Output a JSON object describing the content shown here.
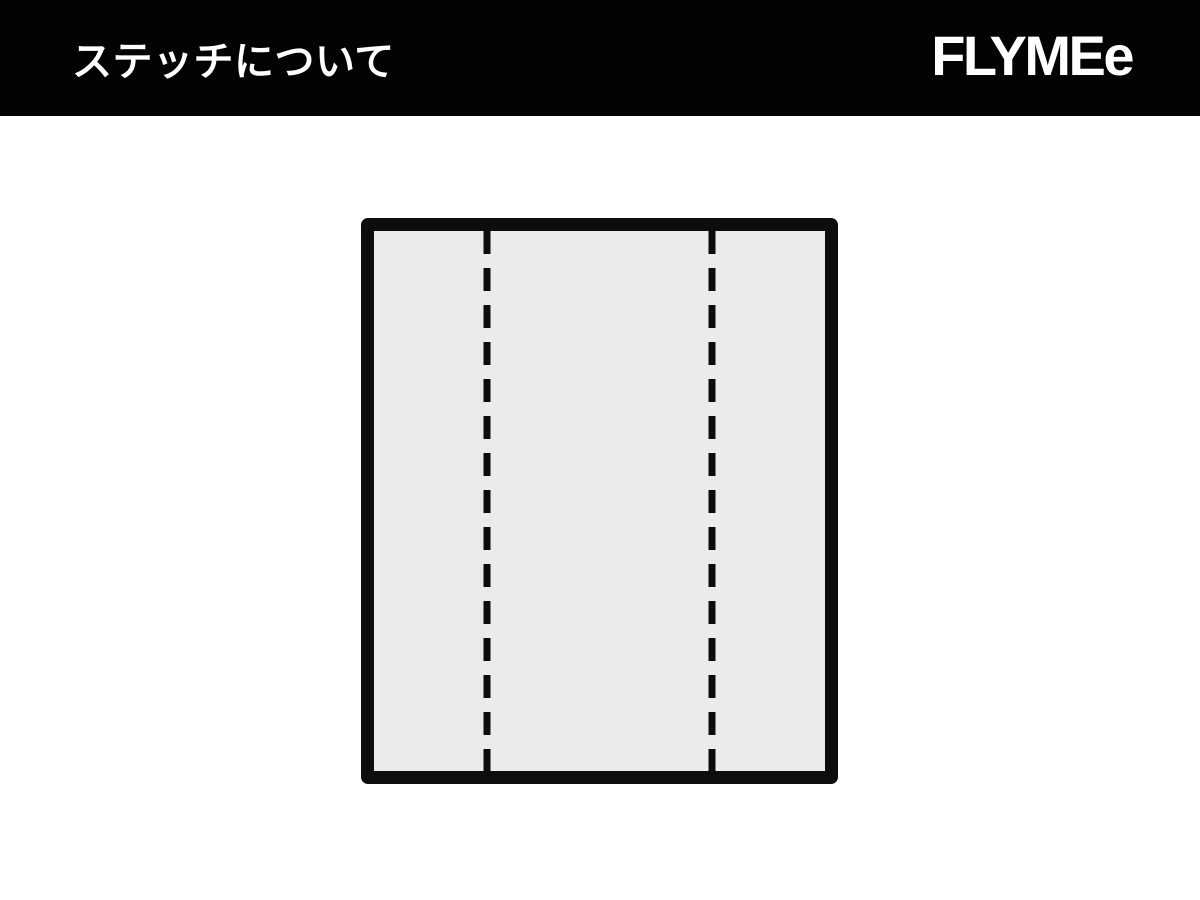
{
  "header": {
    "title": "ステッチについて",
    "logo": "FLYMEe",
    "background_color": "#030303",
    "text_color": "#ffffff"
  },
  "diagram": {
    "label": "stitch-position-diagram",
    "panel_fill_color": "#ebebeb",
    "line_color": "#0d0d0d",
    "stitch_lines": [
      {
        "name": "left-stitch-line",
        "position_percent": 25,
        "style": "dashed"
      },
      {
        "name": "right-stitch-line",
        "position_percent": 75,
        "style": "dashed"
      }
    ]
  }
}
